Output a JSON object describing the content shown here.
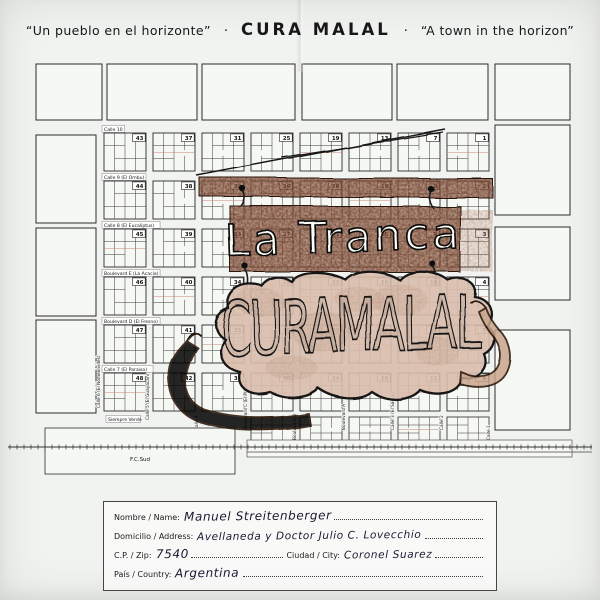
{
  "page": {
    "paper_color": "#f1f3f0",
    "ink_color": "#17171a"
  },
  "title": {
    "left_quote": "“Un pueblo en el horizonte”",
    "separator": "·",
    "main": "CURA MALAL",
    "right_quote": "“A town in the horizon”"
  },
  "map": {
    "block_numbers": [
      [
        "43",
        "37",
        "31",
        "25",
        "19",
        "13",
        "7",
        "1"
      ],
      [
        "44",
        "38",
        "32",
        "26",
        "20",
        "14",
        "8",
        "2"
      ],
      [
        "45",
        "39",
        "33",
        "27",
        "21",
        "15",
        "9",
        "3"
      ],
      [
        "46",
        "40",
        "34",
        "28",
        "22",
        "16",
        "10",
        "4"
      ],
      [
        "47",
        "41",
        "35",
        "29",
        "23",
        "17",
        "11",
        "5"
      ],
      [
        "48",
        "42",
        "36",
        "30",
        "24",
        "18",
        "12",
        "6"
      ]
    ],
    "horizontal_streets": [
      "Calle 10",
      "Calle 9 (El Ombu)",
      "Calle 8 (El Eucaliptus)",
      "Boulevard E (La Acacia)",
      "Boulevard D (El Fresno)",
      "Calle 7 (El Paraiso)"
    ],
    "bottom_street": "Siempre Verde",
    "vertical_streets": [
      "Calle 6 (El Nomeolvides)",
      "Calle 5 (El Guayacan)",
      "Calle 4",
      "Boulevard C (El Platano)",
      "Boulevard B",
      "Boulevard A",
      "Calle 3 (El Sauce)",
      "Calle 2",
      "Calle 1"
    ],
    "railway_label": "F.C.Sud",
    "overlay": {
      "gate_text": "La Tranca",
      "hide_text": "CURAMALAL",
      "bar_color": "#6b3c2a",
      "bar_light_color": "#a47053",
      "hide_color": "#d9bdac",
      "hide_spot_color": "#b08a72",
      "ink_color": "#141414"
    }
  },
  "form": {
    "name_label": "Nombre / Name:",
    "name_value": "Manuel Streitenberger",
    "address_label": "Domicilio / Address:",
    "address_value": "Avellaneda  y  Doctor  Julio C.  Lovecchio",
    "zip_label": "C.P. / Zip:",
    "zip_value": "7540",
    "city_label": "Ciudad / City:",
    "city_value": "Coronel Suarez",
    "country_label": "País / Country:",
    "country_value": "Argentina"
  }
}
